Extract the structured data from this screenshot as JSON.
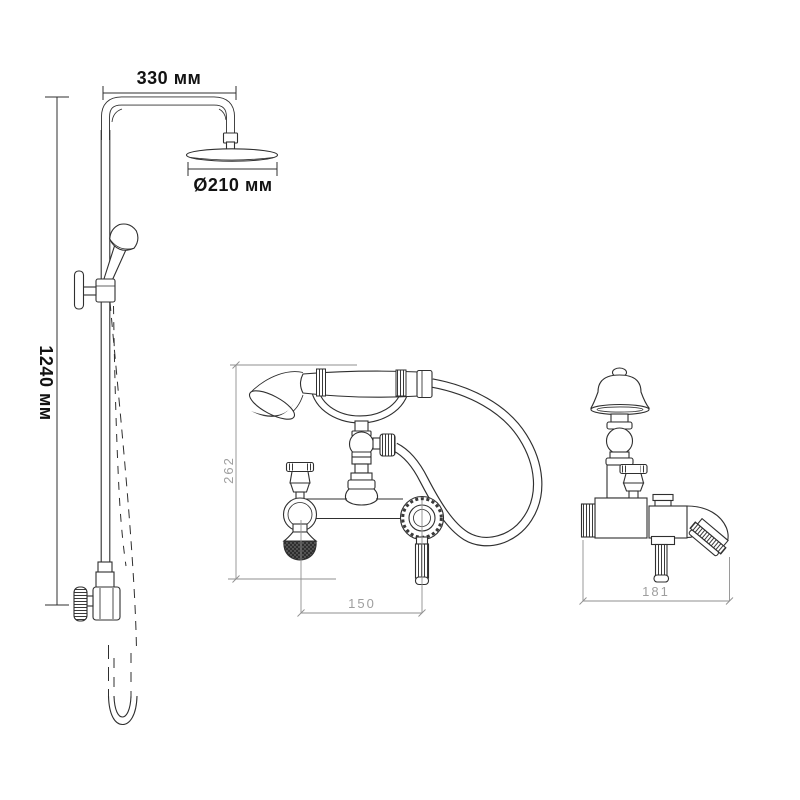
{
  "colors": {
    "background": "#ffffff",
    "line": "#2f2f2f",
    "dim_text_bold": "#121212",
    "dim_text_light": "#9e9e9e",
    "dim_line_light": "#8f8f8f"
  },
  "views": {
    "shower_column": {
      "dims": {
        "arm_width": "330 мм",
        "head_diameter": "Ø210 мм",
        "column_height": "1240 мм"
      }
    },
    "mixer_front": {
      "dims": {
        "height": "262",
        "spout_to_lever": "150"
      }
    },
    "mixer_side": {
      "dims": {
        "depth": "181"
      }
    }
  }
}
